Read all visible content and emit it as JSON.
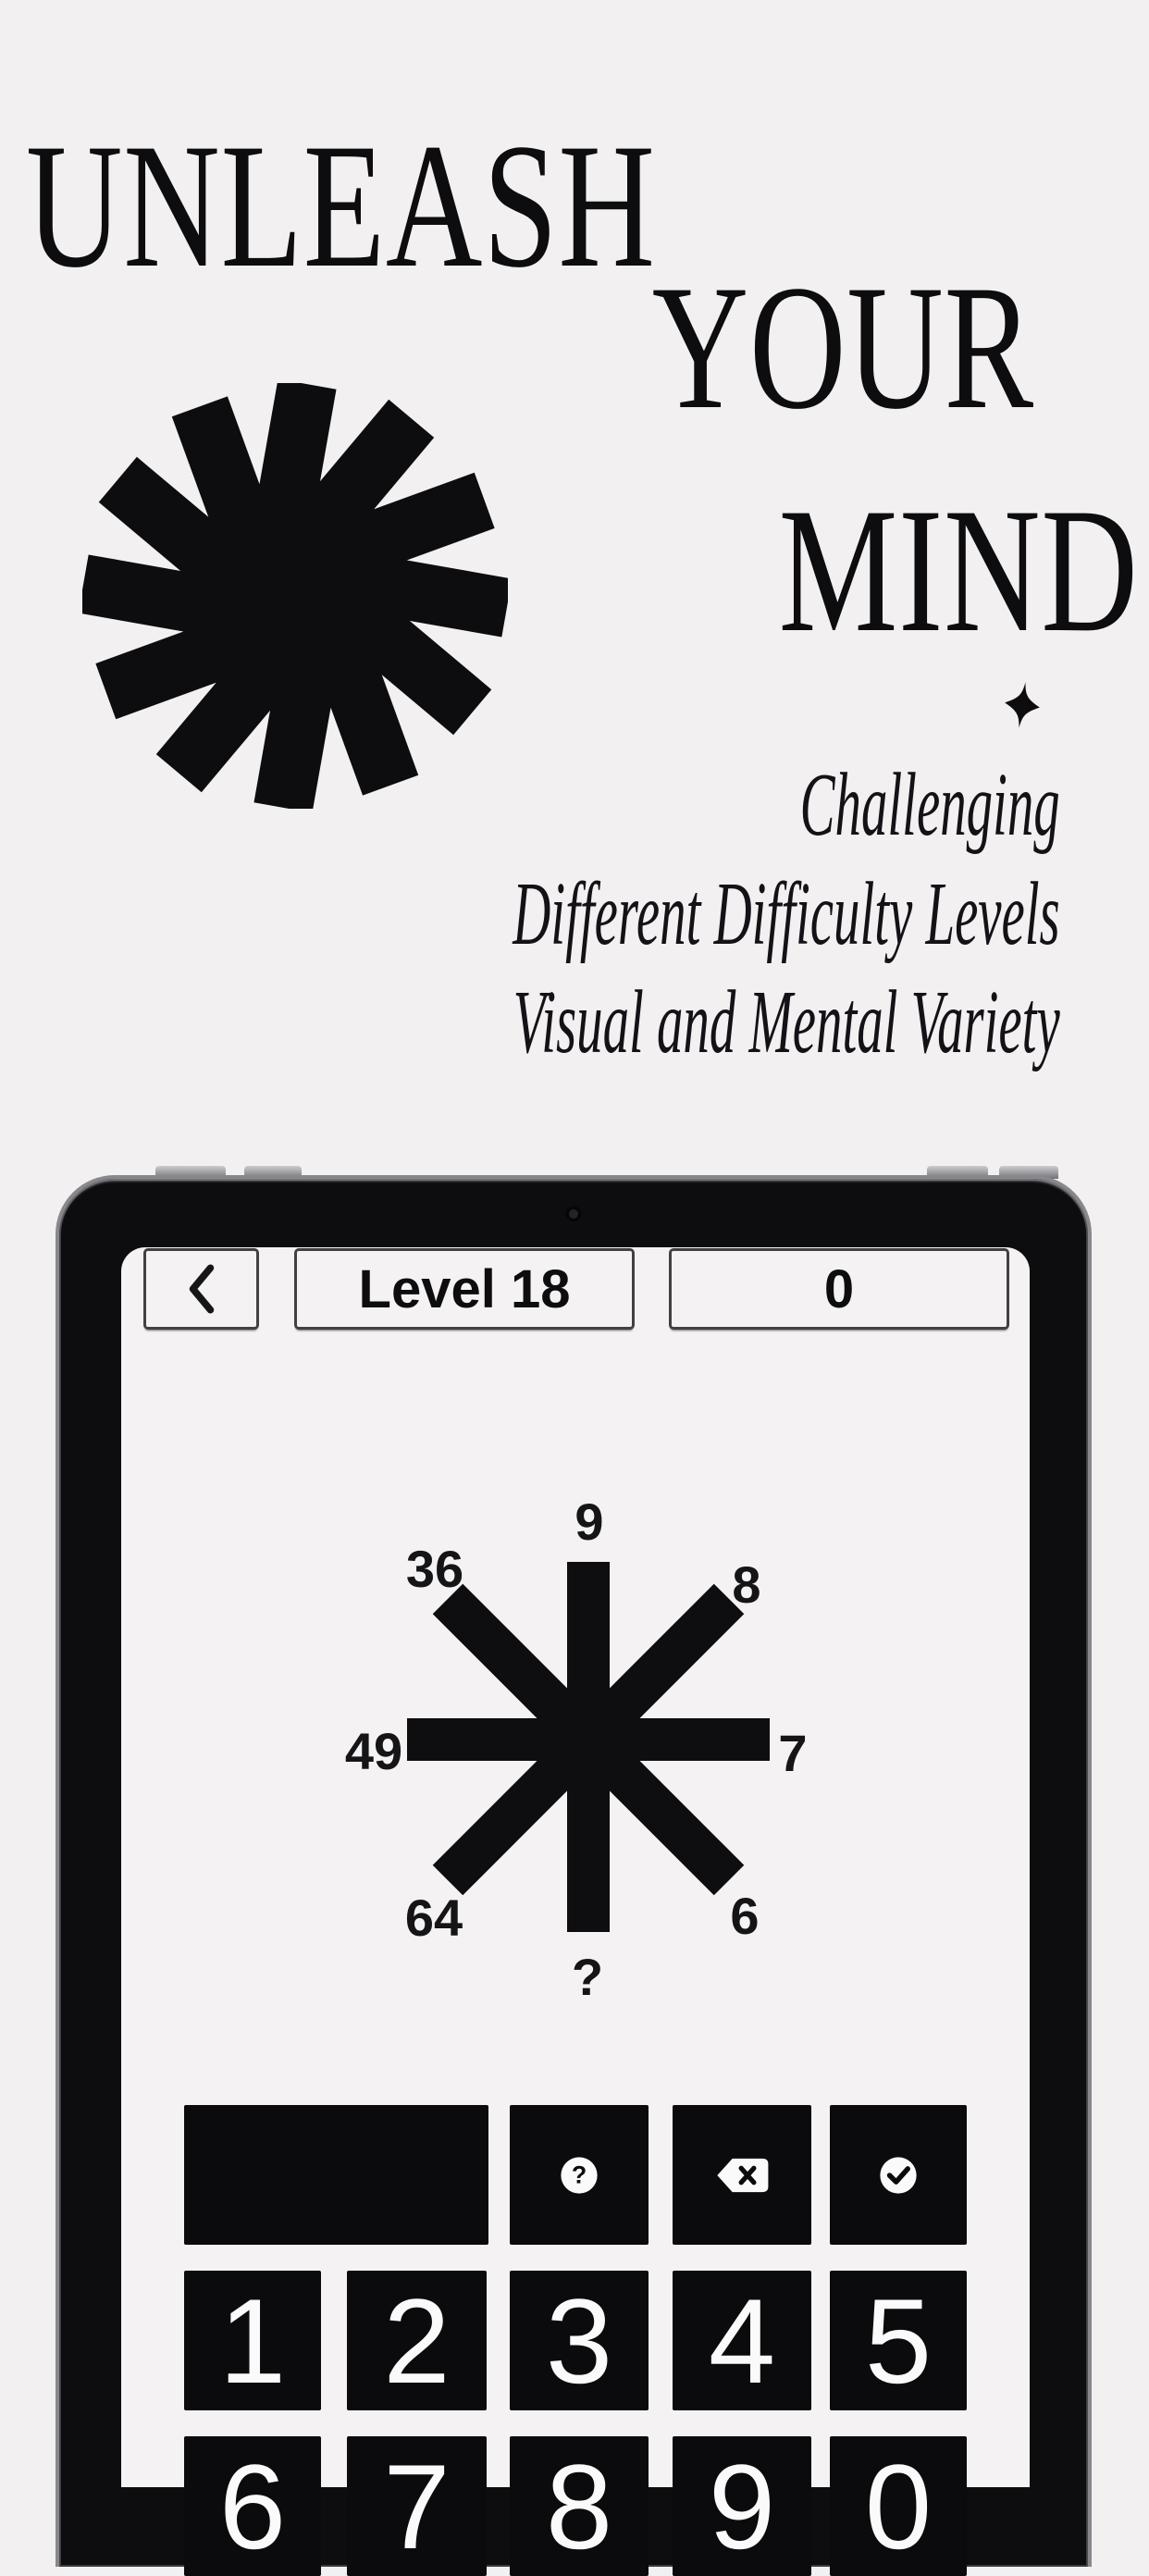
{
  "page": {
    "background": "#f2f0f1",
    "ink": "#0d0c0e"
  },
  "hero": {
    "title_line1": "UNLEASH",
    "title_line2": "YOUR",
    "title_line3": "MIND",
    "features": {
      "line1": "Challenging",
      "line2": "Different Difficulty Levels",
      "line3": "Visual and Mental Variety"
    }
  },
  "tablet": {
    "status_bar": {
      "level_label": "Level 18",
      "score_value": "0"
    },
    "puzzle": {
      "top": "9",
      "top_right": "8",
      "right": "7",
      "bottom_right": "6",
      "bottom": "?",
      "bottom_left": "64",
      "left": "49",
      "top_left": "36"
    },
    "keypad": {
      "display_value": "",
      "help_glyph": "?",
      "digits": [
        "1",
        "2",
        "3",
        "4",
        "5",
        "6",
        "7",
        "8",
        "9",
        "0"
      ]
    }
  },
  "icons": {
    "back": "chevron-left",
    "help": "question-mark-circle",
    "backspace": "backspace-x",
    "confirm": "check-circle",
    "decor": [
      "starburst-pinwheel",
      "four-point-sparkle"
    ]
  }
}
